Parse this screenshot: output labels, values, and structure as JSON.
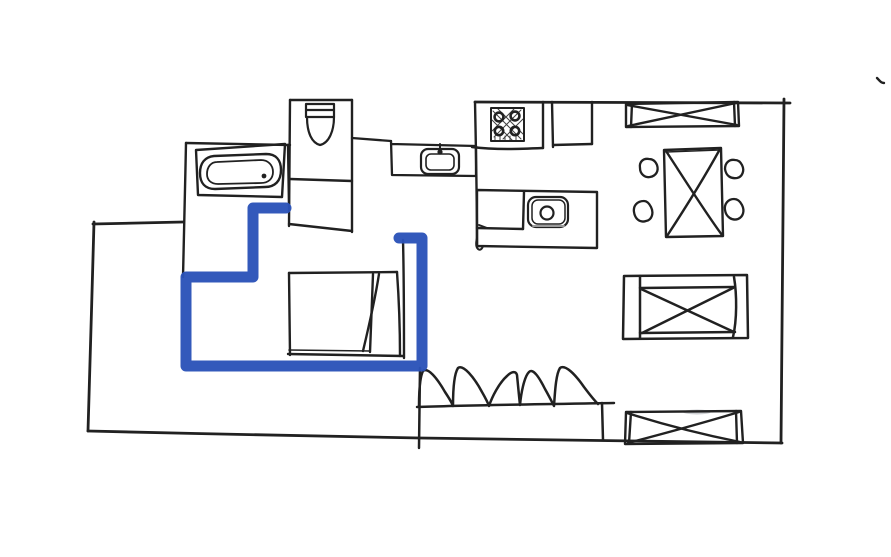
{
  "canvas": {
    "width": 891,
    "height": 557,
    "background_color": "#ffffff",
    "description": "hand-drawn apartment floor plan sketch, black ink on white, one room outlined with a thick blue marker"
  },
  "sketch": {
    "ink_color": "#212121",
    "highlight": {
      "color": "#2b52b8",
      "stroke_width": 11,
      "points": "286,208 253,208 253,277 186,277 186,366 422,366 422,238 399,238",
      "encloses": "bedroom"
    },
    "rooms": [
      {
        "name": "bathroom"
      },
      {
        "name": "toilet-room"
      },
      {
        "name": "kitchen"
      },
      {
        "name": "dining-area"
      },
      {
        "name": "bedroom"
      },
      {
        "name": "living-area"
      }
    ],
    "furniture": [
      {
        "name": "bathtub"
      },
      {
        "name": "toilet"
      },
      {
        "name": "kitchen-sink"
      },
      {
        "name": "stove-cooktop"
      },
      {
        "name": "kitchen-island"
      },
      {
        "name": "island-appliance"
      },
      {
        "name": "dining-table"
      },
      {
        "name": "dining-chair",
        "count": 4
      },
      {
        "name": "wall-shelf-crossed"
      },
      {
        "name": "daybed-crossed"
      },
      {
        "name": "storage-bench-crossed"
      },
      {
        "name": "sofa-scalloped"
      },
      {
        "name": "bed-with-pillow"
      }
    ]
  }
}
